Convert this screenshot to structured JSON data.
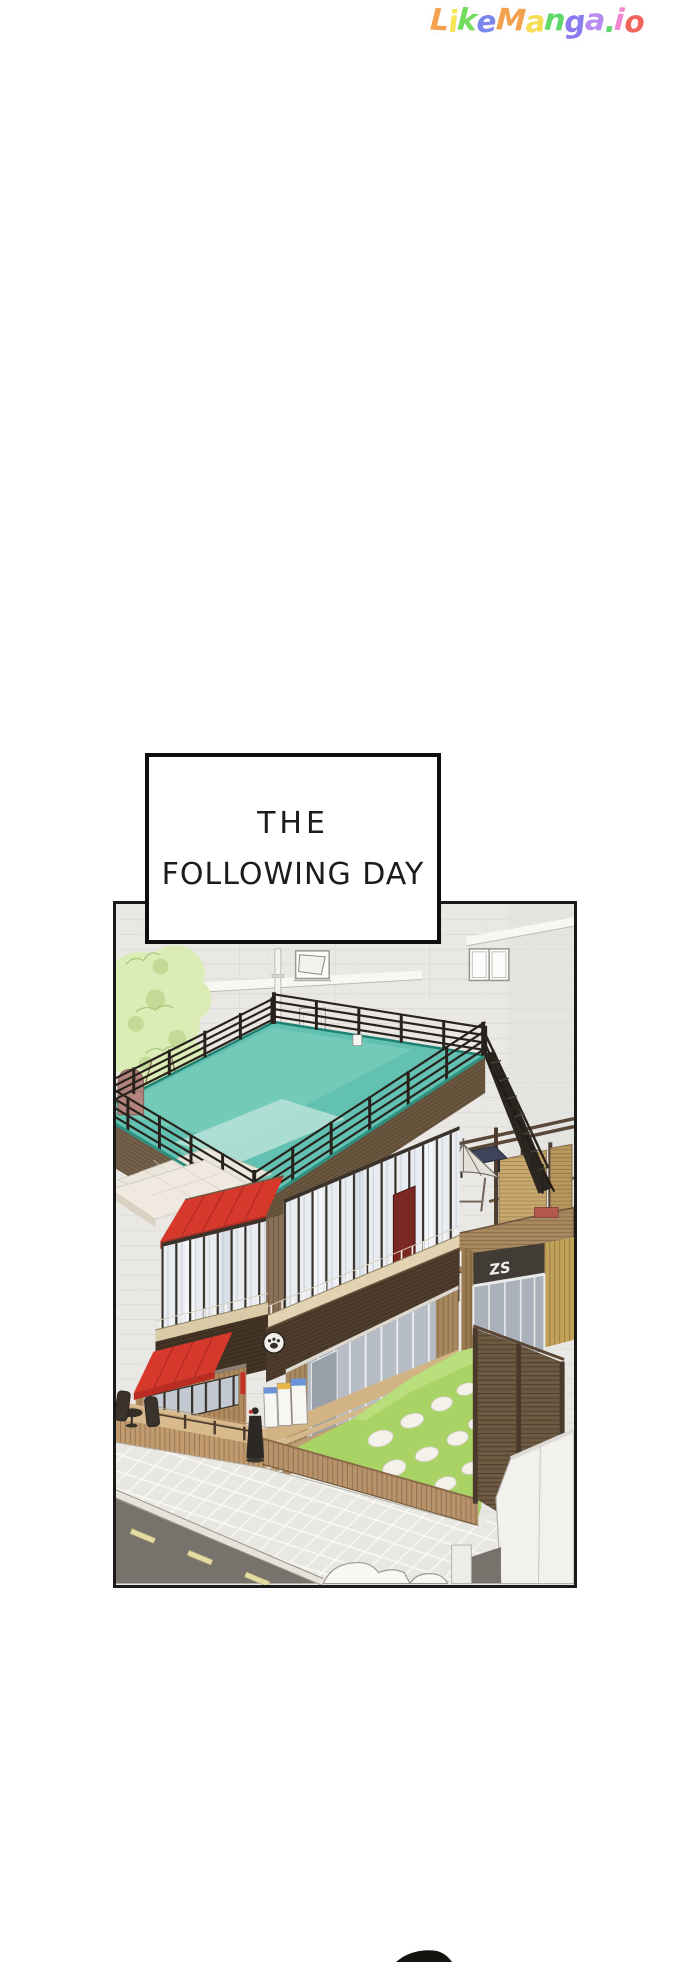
{
  "site": {
    "logo_text": "LikeManga.io",
    "logo_letters": [
      {
        "ch": "L",
        "color": "#f4a14f"
      },
      {
        "ch": "i",
        "color": "#f6e554"
      },
      {
        "ch": "k",
        "color": "#72dd5d"
      },
      {
        "ch": "e",
        "color": "#7d88ec"
      },
      {
        "ch": "M",
        "color": "#f4a14f"
      },
      {
        "ch": "a",
        "color": "#f6dd54"
      },
      {
        "ch": "n",
        "color": "#5fd868"
      },
      {
        "ch": "g",
        "color": "#8a7cf0"
      },
      {
        "ch": "a",
        "color": "#b88cf0"
      },
      {
        "ch": ".",
        "color": "#5ad56a"
      },
      {
        "ch": "i",
        "color": "#f487d2"
      },
      {
        "ch": "o",
        "color": "#f2655c"
      }
    ]
  },
  "caption": {
    "line1": "THE",
    "line2": "FOLLOWING DAY"
  },
  "panel": {
    "description": "Isometric manga illustration of a two-story cafe building with a teal rooftop pool deck surrounded by black railings, red awnings, glass storefront, wooden deck and stairs, green lawn with stepping stones, wooden fences, sidewalk and road, against a large gray tiled wall with a tree",
    "sign_text": "ZS"
  },
  "palette": {
    "pool_teal": "#62c1b0",
    "pool_rim": "#1f8071",
    "awning_red": "#d6382c",
    "lawn_green": "#a9d465",
    "wood_tan": "#c9a87c",
    "fascia_brown": "#6b573f",
    "dark_fascia": "#4e3c2c",
    "railing_black": "#28221d",
    "wall_gray": "#e9e8e5",
    "road_gray": "#77726c",
    "lane_yellow": "#e4dca2",
    "tree_green": "#dcecb6",
    "caption_ink": "#1c1c1c"
  }
}
